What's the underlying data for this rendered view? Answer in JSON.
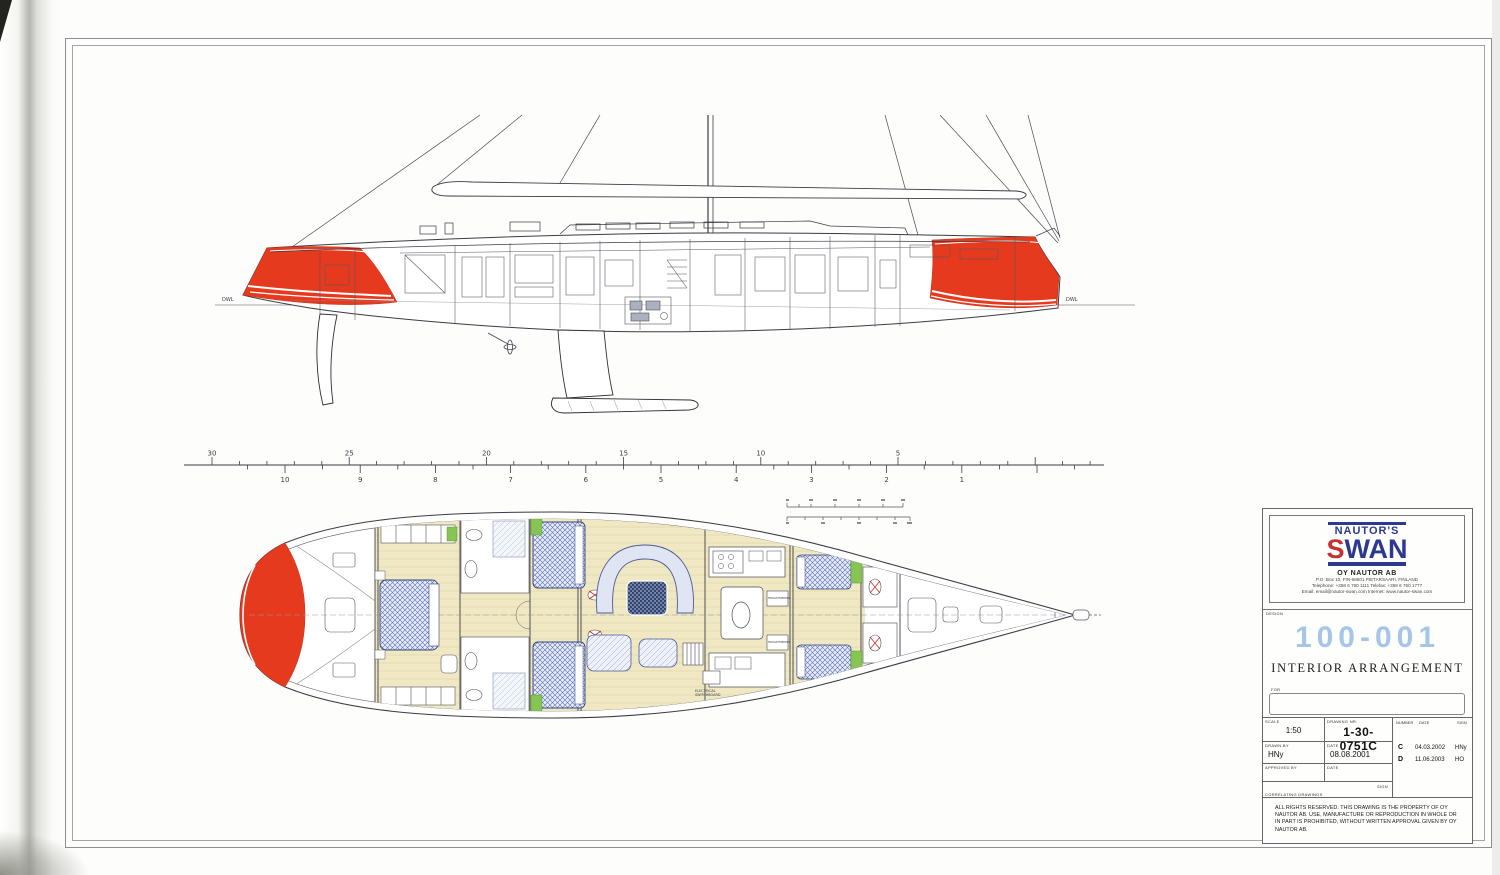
{
  "colors": {
    "hull_red": "#e63a1f",
    "brand_navy": "#2b3990",
    "brand_red_s": "#c4332e",
    "project_number_blue": "#a5c6e6",
    "cabin_sole_yellow": "#efe8c2",
    "berth_blue": "#5a6fb5",
    "upholstery_green": "#86c554",
    "line_ink": "#3b3b45"
  },
  "profile": {
    "dwl_left": "DWL",
    "dwl_right": "DWL"
  },
  "ruler": {
    "top_labels": [
      "30",
      "25",
      "20",
      "15",
      "10",
      "5"
    ],
    "bottom_labels": [
      "10",
      "9",
      "8",
      "7",
      "6",
      "5",
      "4",
      "3",
      "2",
      "1"
    ]
  },
  "plan": {
    "electrical_label_line1": "ELECTRICAL",
    "electrical_label_line2": "SWITCHBOARD",
    "fridge_label": "FRIDGE/FREEZER"
  },
  "title_block": {
    "brand": {
      "name_top": "NAUTOR'S",
      "name_swan_s": "S",
      "name_swan_rest": "WAN",
      "company": "OY NAUTOR AB",
      "address": "P.O. Box 10, FIN-68601 PIETARSAARI, FINLAND",
      "phone": "Telephone: +358 6 760 1111    Telefax: +358 6 760 1777",
      "email": "Email: email@nautor-swan.com      Internet: www.nautor-swan.com"
    },
    "design_label": "DESIGN",
    "project_number": "100-001",
    "drawing_title": "INTERIOR ARRANGEMENT",
    "for_label": "FOR",
    "form": {
      "scale_label": "SCALE",
      "scale_value": "1:50",
      "drawing_nr_label": "DRAWING NR.",
      "drawing_nr_value": "1-30-0751C",
      "number_label": "NUMBER",
      "date_label": "DATE",
      "sign_label": "SIGN",
      "drawn_by_label": "DRAWN BY",
      "drawn_by_value": "HNy",
      "date2_label": "DATE",
      "date2_value": "08.08.2001",
      "approved_by_label": "APPROVED BY",
      "date3_label": "DATE",
      "correlating_label": "CORRELATING DRAWINGS",
      "sign2_label": "SIGN",
      "revisions": [
        {
          "number": "C",
          "date": "04.03.2002",
          "sign": "HNy"
        },
        {
          "number": "D",
          "date": "11.06.2003",
          "sign": "HO"
        }
      ]
    },
    "disclaimer": "ALL RIGHTS RESERVED. THIS DRAWING IS THE PROPERTY OF OY NAUTOR AB. USE, MANUFACTURE OR REPRODUCTION IN WHOLE OR IN PART IS PROHIBITED, WITHOUT WRITTEN APPROVAL GIVEN BY OY NAUTOR AB."
  }
}
